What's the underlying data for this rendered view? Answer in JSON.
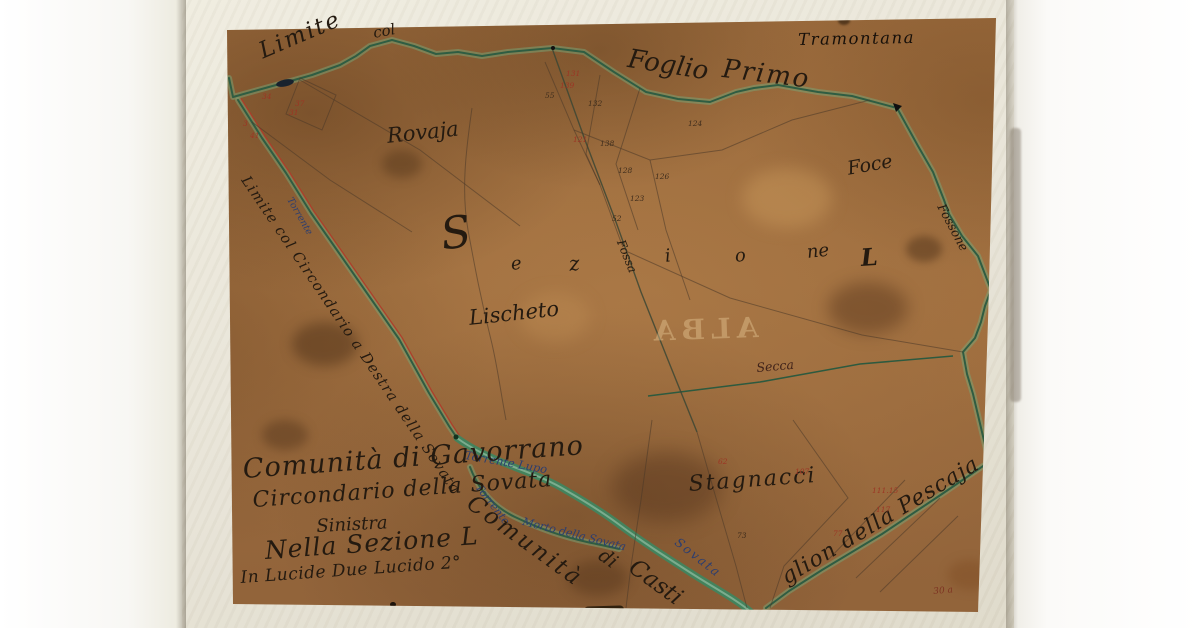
{
  "palette": {
    "paper_brown": "#9c6b3e",
    "mat_cream": "#e9e5d8",
    "boundary_green": "#2f5d42",
    "road_red": "#b03a28",
    "water_blue": "#2c3e70",
    "ink": "#241a10",
    "red_ink": "#9c3524"
  },
  "labels": {
    "limite": "Limite",
    "col": "col",
    "foglio": "Foglio",
    "primo": "Primo",
    "tramontana": "Tramontana",
    "rovaja": "Rovaja",
    "sez_s": "S",
    "sez_e": "e",
    "sez_z": "z",
    "sez_i": "i",
    "sez_o": "o",
    "sez_ne": "ne",
    "sez_l": "L",
    "lischeto": "Lischeto",
    "foce": "Foce",
    "fossone": "Fossone",
    "fossa": "Fossa",
    "secca": "Secca",
    "stagnacci": "Stagnacci",
    "road": "Limite col Circondario a Destra della Sovata",
    "torrente_sm": "Torrente",
    "torrente_lupo": "Torrente Lupo",
    "torrente_morto": "Torrente",
    "morto_rest": "Morto della Sovata",
    "sovata": "Sovata",
    "comunita": "Comunità",
    "di": "di",
    "casti": "Casti",
    "pescaja": "glion della Pescaja",
    "cart1": "Comunità di Gavorrano",
    "cart2": "Circondario della Sovata",
    "cart3": "Sinistra",
    "cart4": "Nella Sezione L",
    "cart5": "In Lucide Due Lucido 2°",
    "ghost": "ALBA",
    "corner": "30 a"
  },
  "nums": {
    "r1": "131",
    "r2": "139",
    "r3": "37",
    "r4": "34",
    "r5": "31",
    "r6": "121",
    "r7": "111.15",
    "r8": "117",
    "r9": "77",
    "r10": "62",
    "r11": "107",
    "r12": "3",
    "r13": "41",
    "s1": "132",
    "s2": "138",
    "s3": "124",
    "s4": "128",
    "s5": "126",
    "s6": "123",
    "s7": "55",
    "s8": "52",
    "s9": "73"
  }
}
